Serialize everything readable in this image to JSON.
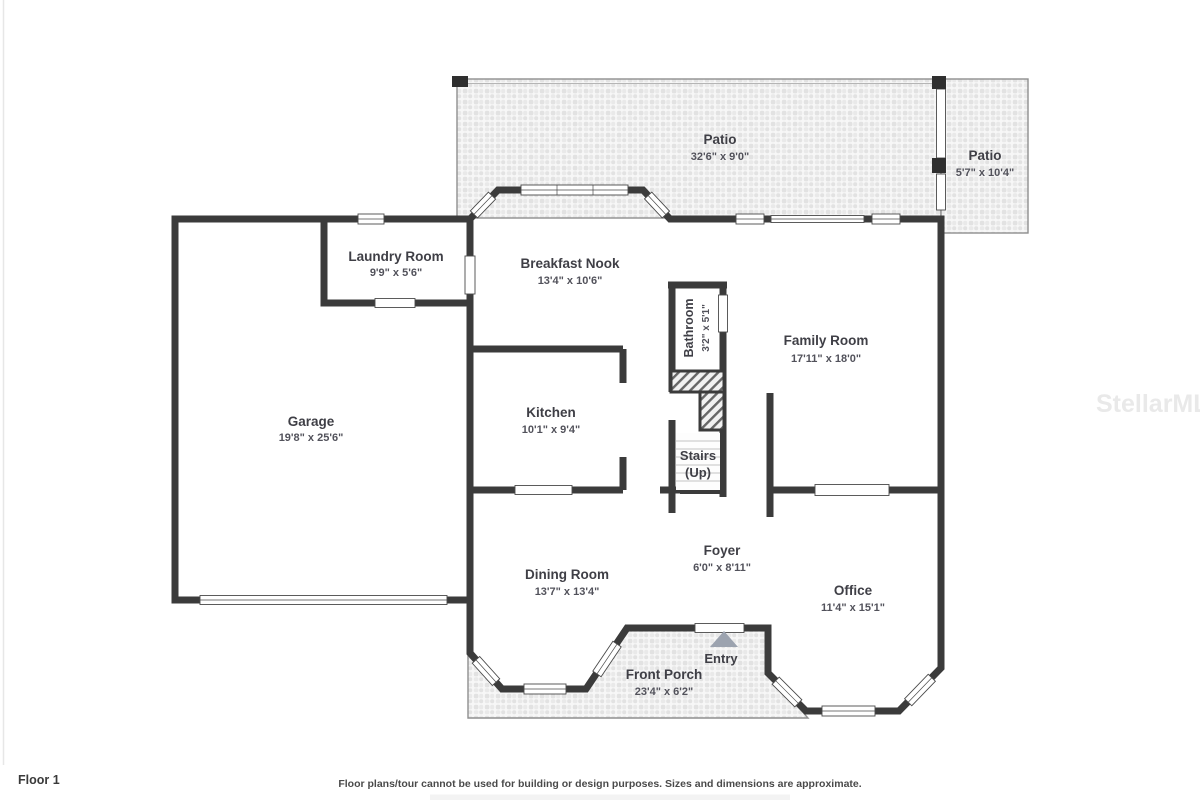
{
  "plan": {
    "rooms": {
      "patio_main": {
        "name": "Patio",
        "dims": "32'6\" x 9'0\""
      },
      "patio_side": {
        "name": "Patio",
        "dims": "5'7\" x 10'4\""
      },
      "laundry": {
        "name": "Laundry Room",
        "dims": "9'9\" x 5'6\""
      },
      "breakfast": {
        "name": "Breakfast Nook",
        "dims": "13'4\" x 10'6\""
      },
      "bathroom": {
        "name": "Bathroom",
        "dims": "3'2\" x 5'1\""
      },
      "family_room": {
        "name": "Family Room",
        "dims": "17'11\" x 18'0\""
      },
      "garage": {
        "name": "Garage",
        "dims": "19'8\" x 25'6\""
      },
      "kitchen": {
        "name": "Kitchen",
        "dims": "10'1\" x 9'4\""
      },
      "stairs": {
        "name": "Stairs",
        "direction": "(Up)"
      },
      "foyer": {
        "name": "Foyer",
        "dims": "6'0\" x 8'11\""
      },
      "dining_room": {
        "name": "Dining Room",
        "dims": "13'7\" x 13'4\""
      },
      "office": {
        "name": "Office",
        "dims": "11'4\" x 15'1\""
      },
      "front_porch": {
        "name": "Front Porch",
        "dims": "23'4\" x 6'2\""
      },
      "entry": {
        "name": "Entry"
      }
    },
    "colors": {
      "wall": "#3b3b3b",
      "room_fill": "#f4f4f5",
      "label_text": "#3f3f46",
      "dims_text": "#52525b",
      "entry_arrow": "#9ca3af",
      "watermark": "#e9e9e9"
    },
    "footer": {
      "floor_label": "Floor 1",
      "disclaimer": "Floor plans/tour cannot be used for building or design purposes. Sizes and dimensions are approximate."
    },
    "watermark": "StellarMLS"
  }
}
